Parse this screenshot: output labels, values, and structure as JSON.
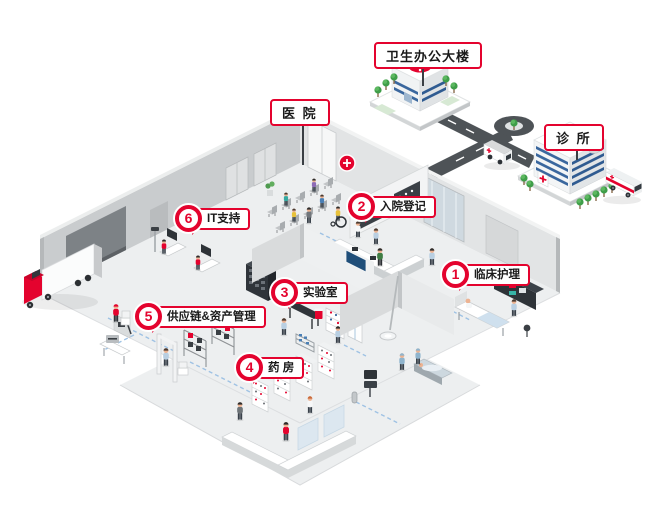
{
  "illustration": {
    "description": "isometric hospital cutaway infographic",
    "title_labels": {
      "hospital": "医 院",
      "health_office": "卫生办公大楼",
      "clinic": "诊 所"
    },
    "areas": [
      {
        "number": "1",
        "label": "临床护理"
      },
      {
        "number": "2",
        "label": "入院登记"
      },
      {
        "number": "3",
        "label": "实验室"
      },
      {
        "number": "4",
        "label": "药 房"
      },
      {
        "number": "5",
        "label": "供应链&资产管理"
      },
      {
        "number": "6",
        "label": "IT支持"
      }
    ],
    "colors": {
      "accent_red": "#e4032e",
      "wall_gray": "#c9ccce",
      "floor_gray": "#edeff0",
      "road_gray": "#4e5357",
      "window_blue": "#3a679e",
      "scrub_blue": "#b9cfe2",
      "path_blue": "#9fc2e4",
      "tree_green": "#3f9e49"
    }
  }
}
